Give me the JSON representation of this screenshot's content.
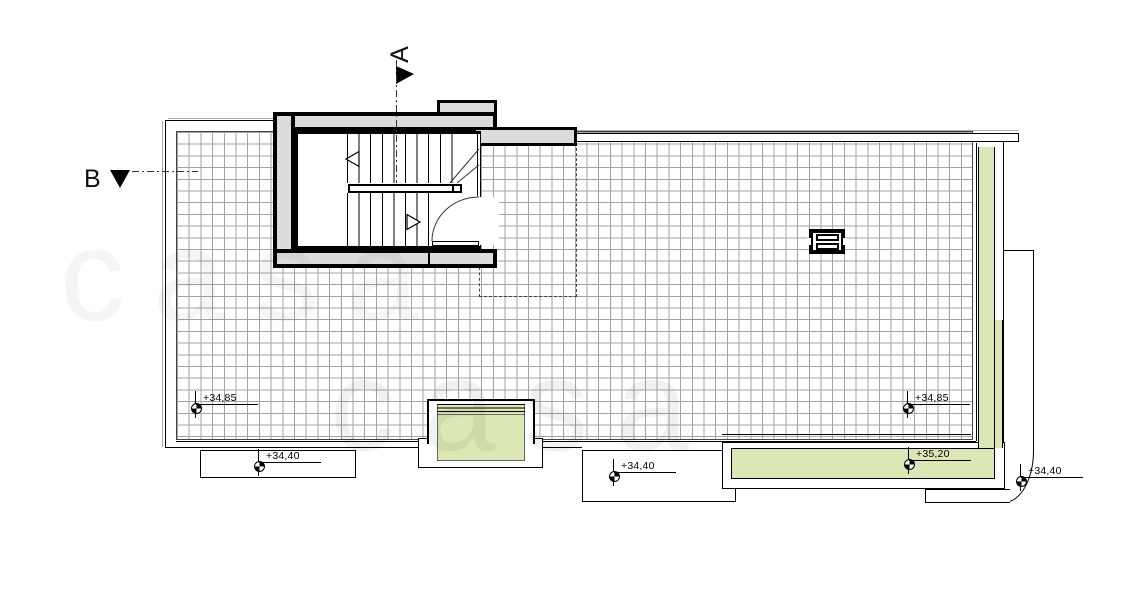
{
  "sections": {
    "a_label": "A",
    "b_label": "B"
  },
  "levels": [
    {
      "value": "+34,85"
    },
    {
      "value": "+34,40"
    },
    {
      "value": "+34,40"
    },
    {
      "value": "+34,85"
    },
    {
      "value": "+35,20"
    },
    {
      "value": "+34,40"
    }
  ],
  "watermark": {
    "text": "casa"
  },
  "colors": {
    "planter_green": "#dbe7b6",
    "wall_gray": "#dcdcdc",
    "grid_line": "#a3a3a3",
    "shadow_gray": "#aaaaaa",
    "ink": "#111111"
  }
}
